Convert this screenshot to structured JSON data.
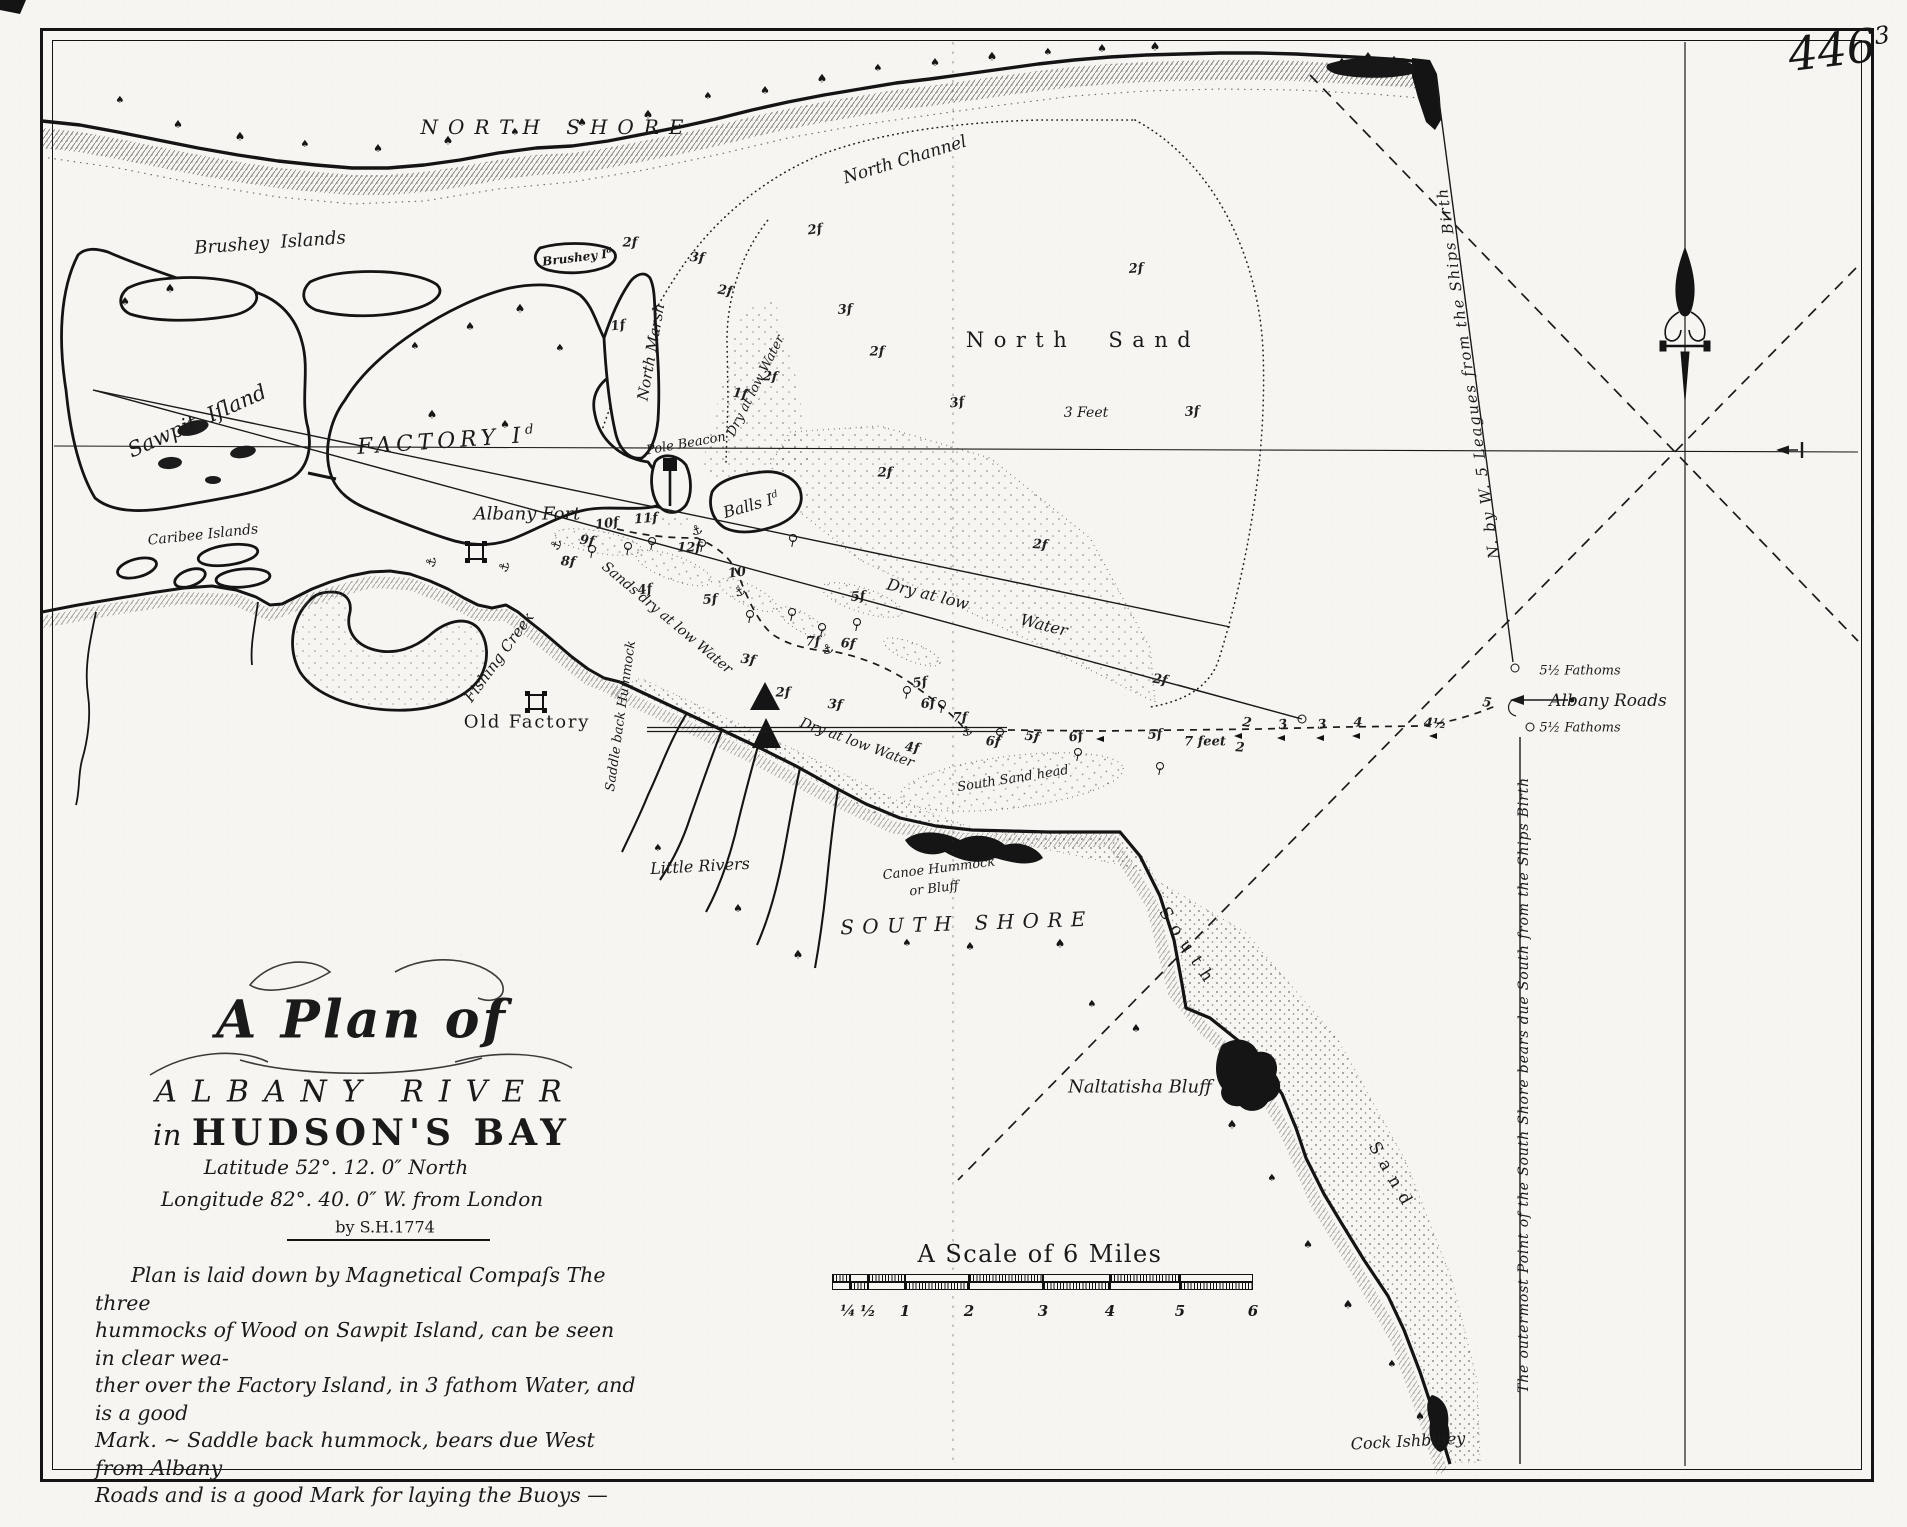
{
  "colors": {
    "ink": "#1a1a1a",
    "paper": "#f6f5f1"
  },
  "page_number": {
    "main": "446",
    "sup": "3"
  },
  "title_block": {
    "line1": "A Plan of",
    "line2": "ALBANY RIVER",
    "line3_prefix": "in ",
    "line3": "HUDSON'S BAY",
    "latitude": "Latitude 52°. 12. 0″ North",
    "longitude": "Longitude 82°. 40. 0″ W. from London",
    "byline": "by S.H.1774"
  },
  "notes": {
    "lines": [
      "Plan is laid down by Magnetical Compaſs  The three",
      "hummocks of Wood on Sawpit Island, can be seen in clear wea-",
      "ther over the Factory Island, in 3 fathom Water, and is a good",
      "Mark. ~  Saddle back hummock, bears due West from Albany",
      "Roads and is a good Mark for laying the Buoys —"
    ]
  },
  "scale_bar": {
    "title": "A Scale of 6 Miles",
    "title_x": 1040,
    "title_y": 1254,
    "boundaries": [
      832,
      850,
      868,
      905,
      969,
      1043,
      1110,
      1180,
      1253
    ],
    "row1_y": 1274,
    "row2_y": 1282,
    "tick_y": 1302,
    "ticks": [
      {
        "t": "¼",
        "x": 848
      },
      {
        "t": "½",
        "x": 868
      },
      {
        "t": "1",
        "x": 905
      },
      {
        "t": "2",
        "x": 969
      },
      {
        "t": "3",
        "x": 1043
      },
      {
        "t": "4",
        "x": 1110
      },
      {
        "t": "5",
        "x": 1180
      },
      {
        "t": "6",
        "x": 1253
      }
    ]
  },
  "map_labels": [
    {
      "id": "north-shore",
      "t": "NORTH SHORE",
      "x": 557,
      "y": 127,
      "r": 0,
      "s": 20,
      "ls": 0.5
    },
    {
      "id": "north-channel",
      "t": "North Channel",
      "x": 905,
      "y": 160,
      "r": -17,
      "s": 17
    },
    {
      "id": "north-sand",
      "t": "North  Sand",
      "x": 1083,
      "y": 340,
      "r": 0,
      "s": 21,
      "ls": 0.45,
      "nr": true
    },
    {
      "id": "three-feet",
      "t": "3 Feet",
      "x": 1086,
      "y": 413,
      "r": 0,
      "s": 14
    },
    {
      "id": "brushey-islands",
      "t": "Brushey  Islands",
      "x": 270,
      "y": 243,
      "r": -4,
      "s": 18
    },
    {
      "id": "brushey-island",
      "t": "Brushey I",
      "sup": "d",
      "x": 577,
      "y": 257,
      "r": -7,
      "s": 12,
      "b": true
    },
    {
      "id": "sawpit-island",
      "t": "Sawpit  Iſland",
      "x": 197,
      "y": 421,
      "r": -24,
      "s": 21
    },
    {
      "id": "factory-island",
      "t": "FACTORY I",
      "sup": "d",
      "x": 448,
      "y": 441,
      "r": -4,
      "s": 22,
      "ls": 0.22
    },
    {
      "id": "north-marsh",
      "t": "North Marsh",
      "x": 651,
      "y": 352,
      "r": -80,
      "s": 15
    },
    {
      "id": "pole-beacon",
      "t": "Pole Beacon",
      "x": 686,
      "y": 444,
      "r": -10,
      "s": 13
    },
    {
      "id": "balls-island",
      "t": "Balls I",
      "sup": "d",
      "x": 751,
      "y": 505,
      "r": -16,
      "s": 16
    },
    {
      "id": "albany-fort",
      "t": "Albany Fort",
      "x": 527,
      "y": 514,
      "r": 0,
      "s": 18
    },
    {
      "id": "caribee-islands",
      "t": "Caribee Islands",
      "x": 203,
      "y": 535,
      "r": -6,
      "s": 14
    },
    {
      "id": "fishing-creek",
      "t": "Fishing Creek",
      "x": 499,
      "y": 657,
      "r": -54,
      "s": 15
    },
    {
      "id": "old-factory",
      "t": "Old Factory",
      "x": 527,
      "y": 722,
      "r": 0,
      "s": 18,
      "nr": true,
      "ls": 0.1
    },
    {
      "id": "saddle-back-hummock",
      "t": "Saddle back Hummock",
      "x": 621,
      "y": 716,
      "r": -82,
      "s": 13
    },
    {
      "id": "little-rivers",
      "t": "Little Rivers",
      "x": 700,
      "y": 866,
      "r": -3,
      "s": 16
    },
    {
      "id": "canoe-hummock",
      "t": "Canoe Hummock",
      "x": 939,
      "y": 869,
      "r": -7,
      "s": 13
    },
    {
      "id": "canoe-hummock-2",
      "t": "or Bluff",
      "x": 934,
      "y": 889,
      "r": -7,
      "s": 13
    },
    {
      "id": "south-shore",
      "t": "SOUTH SHORE",
      "x": 967,
      "y": 923,
      "r": -2,
      "s": 20,
      "ls": 0.42
    },
    {
      "id": "south-sand-head",
      "t": "South Sand head",
      "x": 1013,
      "y": 779,
      "r": -9,
      "s": 13
    },
    {
      "id": "naltatisha-bluff",
      "t": "Naltatisha Bluff",
      "x": 1140,
      "y": 1087,
      "r": 0,
      "s": 18
    },
    {
      "id": "south-sand-1",
      "t": "South",
      "x": 1188,
      "y": 948,
      "r": 57,
      "s": 17,
      "ls": 0.5,
      "nr": true
    },
    {
      "id": "south-sand-2",
      "t": "Sand",
      "x": 1392,
      "y": 1177,
      "r": 60,
      "s": 17,
      "ls": 0.5,
      "nr": true
    },
    {
      "id": "cock-ishbiney",
      "t": "Cock Ishbiney",
      "x": 1408,
      "y": 1441,
      "r": -3,
      "s": 16
    },
    {
      "id": "albany-roads",
      "t": "Albany Roads",
      "x": 1608,
      "y": 701,
      "r": 0,
      "s": 17
    },
    {
      "id": "fathoms-upper",
      "t": "5½ Fathoms",
      "x": 1580,
      "y": 671,
      "r": 0,
      "s": 13
    },
    {
      "id": "fathoms-lower",
      "t": "5½ Fathoms",
      "x": 1580,
      "y": 728,
      "r": 0,
      "s": 13
    },
    {
      "id": "bearing-north",
      "t": "N. by W. 5 Leagues from the Ships Birth",
      "x": 1468,
      "y": 373,
      "r": -98,
      "s": 15,
      "ls": 0.12
    },
    {
      "id": "bearing-south",
      "t": "The outermost Point of the South Shore bears due South from the Ships Birth",
      "x": 1524,
      "y": 1085,
      "r": -90,
      "s": 14,
      "ls": 0.06
    },
    {
      "id": "dry-at-low-water-1",
      "t": "Dry at low Water",
      "x": 756,
      "y": 386,
      "r": -63,
      "s": 13
    },
    {
      "id": "dry-at-low-water-2a",
      "t": "Dry at low",
      "x": 928,
      "y": 594,
      "r": 14,
      "s": 16
    },
    {
      "id": "dry-at-low-water-2b",
      "t": "Water",
      "x": 1044,
      "y": 625,
      "r": 14,
      "s": 16
    },
    {
      "id": "sands-dry-at-low-water",
      "t": "Sands dry at low Water",
      "x": 667,
      "y": 618,
      "r": 40,
      "s": 14
    },
    {
      "id": "dry-at-low-water-3",
      "t": "Dry at low Water",
      "x": 857,
      "y": 743,
      "r": 20,
      "s": 14
    }
  ],
  "soundings": [
    [
      "2f",
      815,
      230
    ],
    [
      "2f",
      1136,
      269
    ],
    [
      "2f",
      630,
      243
    ],
    [
      "3f",
      697,
      258
    ],
    [
      "2f",
      725,
      291
    ],
    [
      "1f",
      618,
      326
    ],
    [
      "3f",
      845,
      310
    ],
    [
      "2f",
      877,
      352
    ],
    [
      "2f",
      770,
      377
    ],
    [
      "1f",
      740,
      394
    ],
    [
      "3f",
      957,
      403
    ],
    [
      "3f",
      1192,
      412
    ],
    [
      "2f",
      885,
      473
    ],
    [
      "2f",
      1040,
      545
    ],
    [
      "2f",
      1160,
      680
    ],
    [
      "10f",
      607,
      524
    ],
    [
      "11f",
      646,
      519
    ],
    [
      "12f",
      689,
      548
    ],
    [
      "8f",
      568,
      562
    ],
    [
      "9f",
      587,
      541
    ],
    [
      "10",
      737,
      573
    ],
    [
      "5f",
      858,
      597
    ],
    [
      "7f",
      813,
      642
    ],
    [
      "6f",
      848,
      644
    ],
    [
      "3f",
      748,
      660
    ],
    [
      "4f",
      645,
      590
    ],
    [
      "5f",
      710,
      600
    ],
    [
      "2f",
      783,
      693
    ],
    [
      "3f",
      835,
      705
    ],
    [
      "4f",
      912,
      748
    ],
    [
      "5f",
      920,
      683
    ],
    [
      "6f",
      928,
      704
    ],
    [
      "7f",
      960,
      718
    ],
    [
      "6f",
      993,
      742
    ],
    [
      "5f",
      1032,
      737
    ],
    [
      "6f",
      1076,
      737
    ],
    [
      "5f",
      1155,
      735
    ],
    [
      "7 feet",
      1205,
      742
    ],
    [
      "2",
      1240,
      748
    ],
    [
      "2",
      1247,
      723
    ],
    [
      "3",
      1283,
      725
    ],
    [
      "3",
      1322,
      725
    ],
    [
      "4",
      1358,
      723
    ],
    [
      "4½",
      1435,
      724
    ],
    [
      "5",
      1487,
      703
    ]
  ],
  "markers": {
    "trees": [
      [
        120,
        104
      ],
      [
        178,
        128
      ],
      [
        240,
        140
      ],
      [
        305,
        148
      ],
      [
        378,
        152
      ],
      [
        448,
        144
      ],
      [
        515,
        136
      ],
      [
        582,
        126
      ],
      [
        648,
        118
      ],
      [
        708,
        100
      ],
      [
        765,
        94
      ],
      [
        822,
        82
      ],
      [
        878,
        72
      ],
      [
        935,
        66
      ],
      [
        992,
        60
      ],
      [
        1048,
        56
      ],
      [
        1102,
        52
      ],
      [
        1155,
        50
      ],
      [
        1342,
        66
      ],
      [
        1368,
        60
      ],
      [
        1394,
        64
      ],
      [
        1414,
        70
      ],
      [
        470,
        330
      ],
      [
        520,
        312
      ],
      [
        560,
        352
      ],
      [
        505,
        428
      ],
      [
        432,
        418
      ],
      [
        415,
        350
      ],
      [
        125,
        305
      ],
      [
        170,
        292
      ],
      [
        658,
        852
      ],
      [
        738,
        912
      ],
      [
        798,
        958
      ],
      [
        907,
        947
      ],
      [
        970,
        950
      ],
      [
        1060,
        947
      ],
      [
        1092,
        1008
      ],
      [
        1136,
        1032
      ],
      [
        1232,
        1128
      ],
      [
        1272,
        1182
      ],
      [
        1308,
        1248
      ],
      [
        1348,
        1308
      ],
      [
        1392,
        1368
      ],
      [
        1420,
        1420
      ]
    ],
    "buoys": [
      [
        592,
        549
      ],
      [
        628,
        546
      ],
      [
        652,
        541
      ],
      [
        702,
        543
      ],
      [
        793,
        538
      ],
      [
        750,
        614
      ],
      [
        792,
        612
      ],
      [
        822,
        627
      ],
      [
        857,
        622
      ],
      [
        907,
        690
      ],
      [
        942,
        704
      ],
      [
        1000,
        732
      ],
      [
        1078,
        752
      ],
      [
        1160,
        766
      ]
    ],
    "anchors": [
      [
        432,
        562,
        -80
      ],
      [
        505,
        567,
        -75
      ],
      [
        557,
        545,
        -70
      ],
      [
        697,
        531,
        -20
      ],
      [
        740,
        592,
        -30
      ],
      [
        828,
        650,
        -20
      ],
      [
        967,
        732,
        -15
      ]
    ],
    "darts": [
      [
        1238,
        736
      ],
      [
        1281,
        738
      ],
      [
        1320,
        738
      ],
      [
        1356,
        736
      ],
      [
        1433,
        736
      ],
      [
        1100,
        739
      ]
    ],
    "circles": [
      [
        1515,
        668
      ],
      [
        1530,
        727
      ],
      [
        1302,
        719
      ]
    ],
    "forts": [
      [
        476,
        552
      ],
      [
        536,
        702
      ]
    ]
  }
}
